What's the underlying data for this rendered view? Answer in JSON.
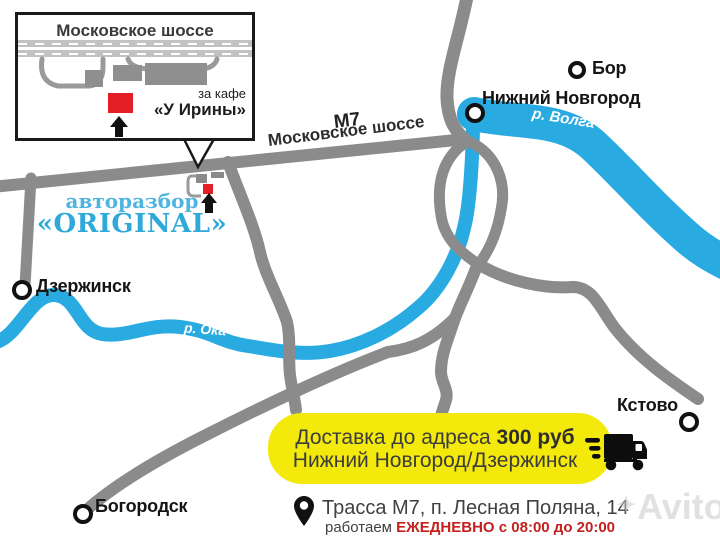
{
  "map": {
    "inset": {
      "title": "Московское шоссе",
      "note_line1": "за кафе",
      "note_line2": "«У Ирины»"
    },
    "brand": {
      "line1": "авторазбор",
      "line2": "«ORIGINAL»"
    },
    "highway": {
      "code": "М7",
      "name": "Московское шоссе"
    },
    "cities": [
      {
        "name": "Бор"
      },
      {
        "name": "Нижний Новгород"
      },
      {
        "name": "Дзержинск"
      },
      {
        "name": "Кстово"
      },
      {
        "name": "Богородск"
      }
    ],
    "rivers": [
      {
        "name": "р. Волга"
      },
      {
        "name": "р. Ока"
      }
    ]
  },
  "delivery_banner": {
    "line1_text": "Доставка до адреса",
    "line1_price": "300 руб",
    "line2": "Нижний Новгород/Дзержинск"
  },
  "footer": {
    "address": "Трасса М7, п. Лесная Поляна, 14",
    "hours_prefix": "работаем",
    "hours": "ЕЖЕДНЕВНО с 08:00 до 20:00"
  },
  "watermark": {
    "mark": "✦",
    "text": "Avito"
  },
  "colors": {
    "river_blue": "#29abe2",
    "road_gray": "#8b8b8b",
    "brand_blue": "#2fa9d9",
    "banner_yellow": "#f3e90b",
    "shop_red": "#e31e24",
    "hours_red": "#c4201e"
  }
}
